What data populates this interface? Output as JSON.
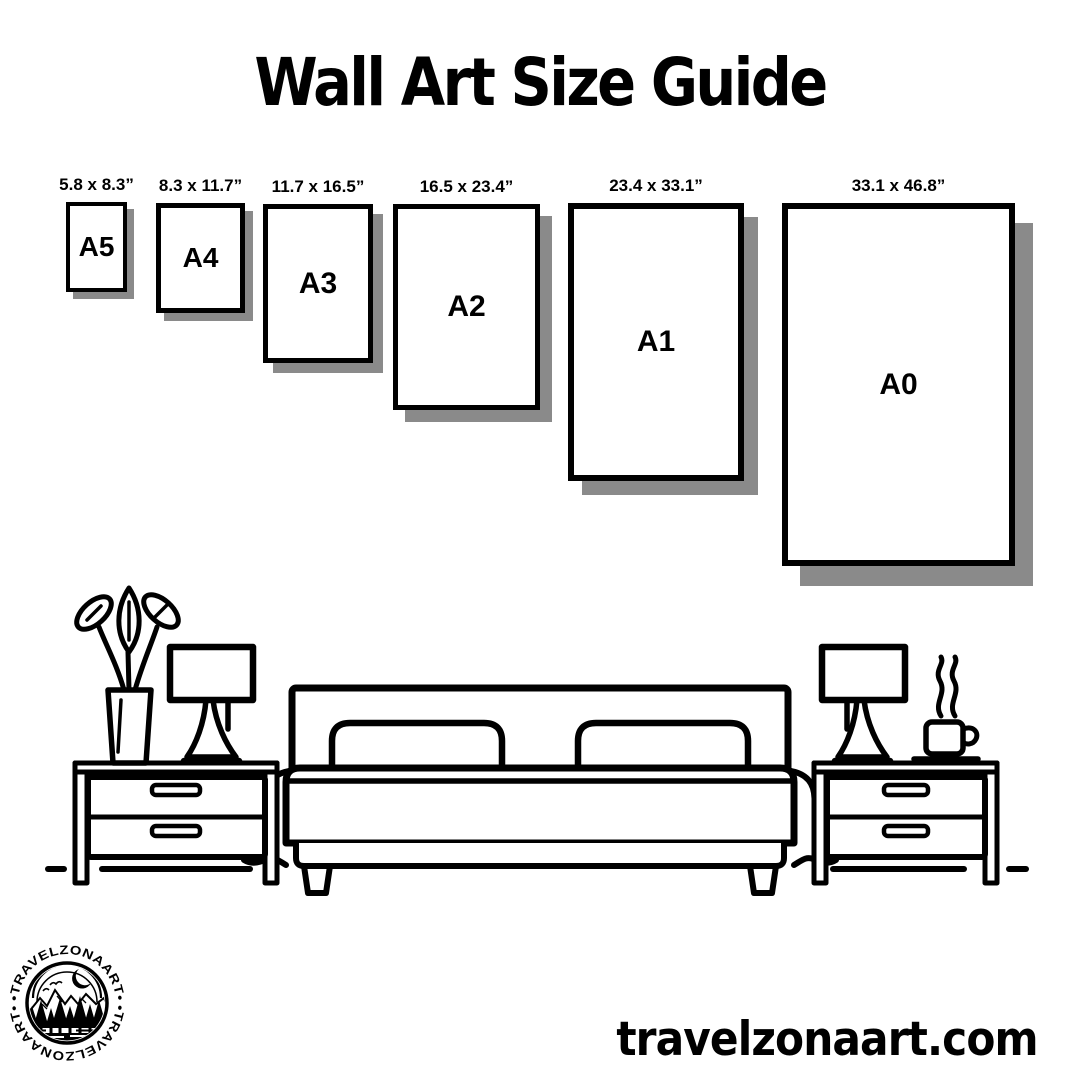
{
  "title": "Wall Art Size Guide",
  "poster_sizes": [
    {
      "name": "A5",
      "dimensions": "5.8 x 8.3”"
    },
    {
      "name": "A4",
      "dimensions": "8.3 x 11.7”"
    },
    {
      "name": "A3",
      "dimensions": "11.7 x 16.5”"
    },
    {
      "name": "A2",
      "dimensions": "16.5 x 23.4”"
    },
    {
      "name": "A1",
      "dimensions": "23.4 x 33.1”"
    },
    {
      "name": "A0",
      "dimensions": "33.1 x 46.8”"
    }
  ],
  "scene": {
    "items": [
      "plant-vase-icon",
      "table-lamp-icon",
      "double-bed-icon",
      "pillow-icon",
      "nightstand-icon",
      "coffee-cup-icon",
      "steam-icon",
      "floor-line-icon"
    ]
  },
  "logo": {
    "brand": "TRAVELZONAART",
    "arc_text": "•TRAVELZONAART•"
  },
  "footer": {
    "website": "travelzonaart.com"
  },
  "colors": {
    "ink": "#000000",
    "shadow": "#8a8a8a",
    "background": "#ffffff"
  }
}
